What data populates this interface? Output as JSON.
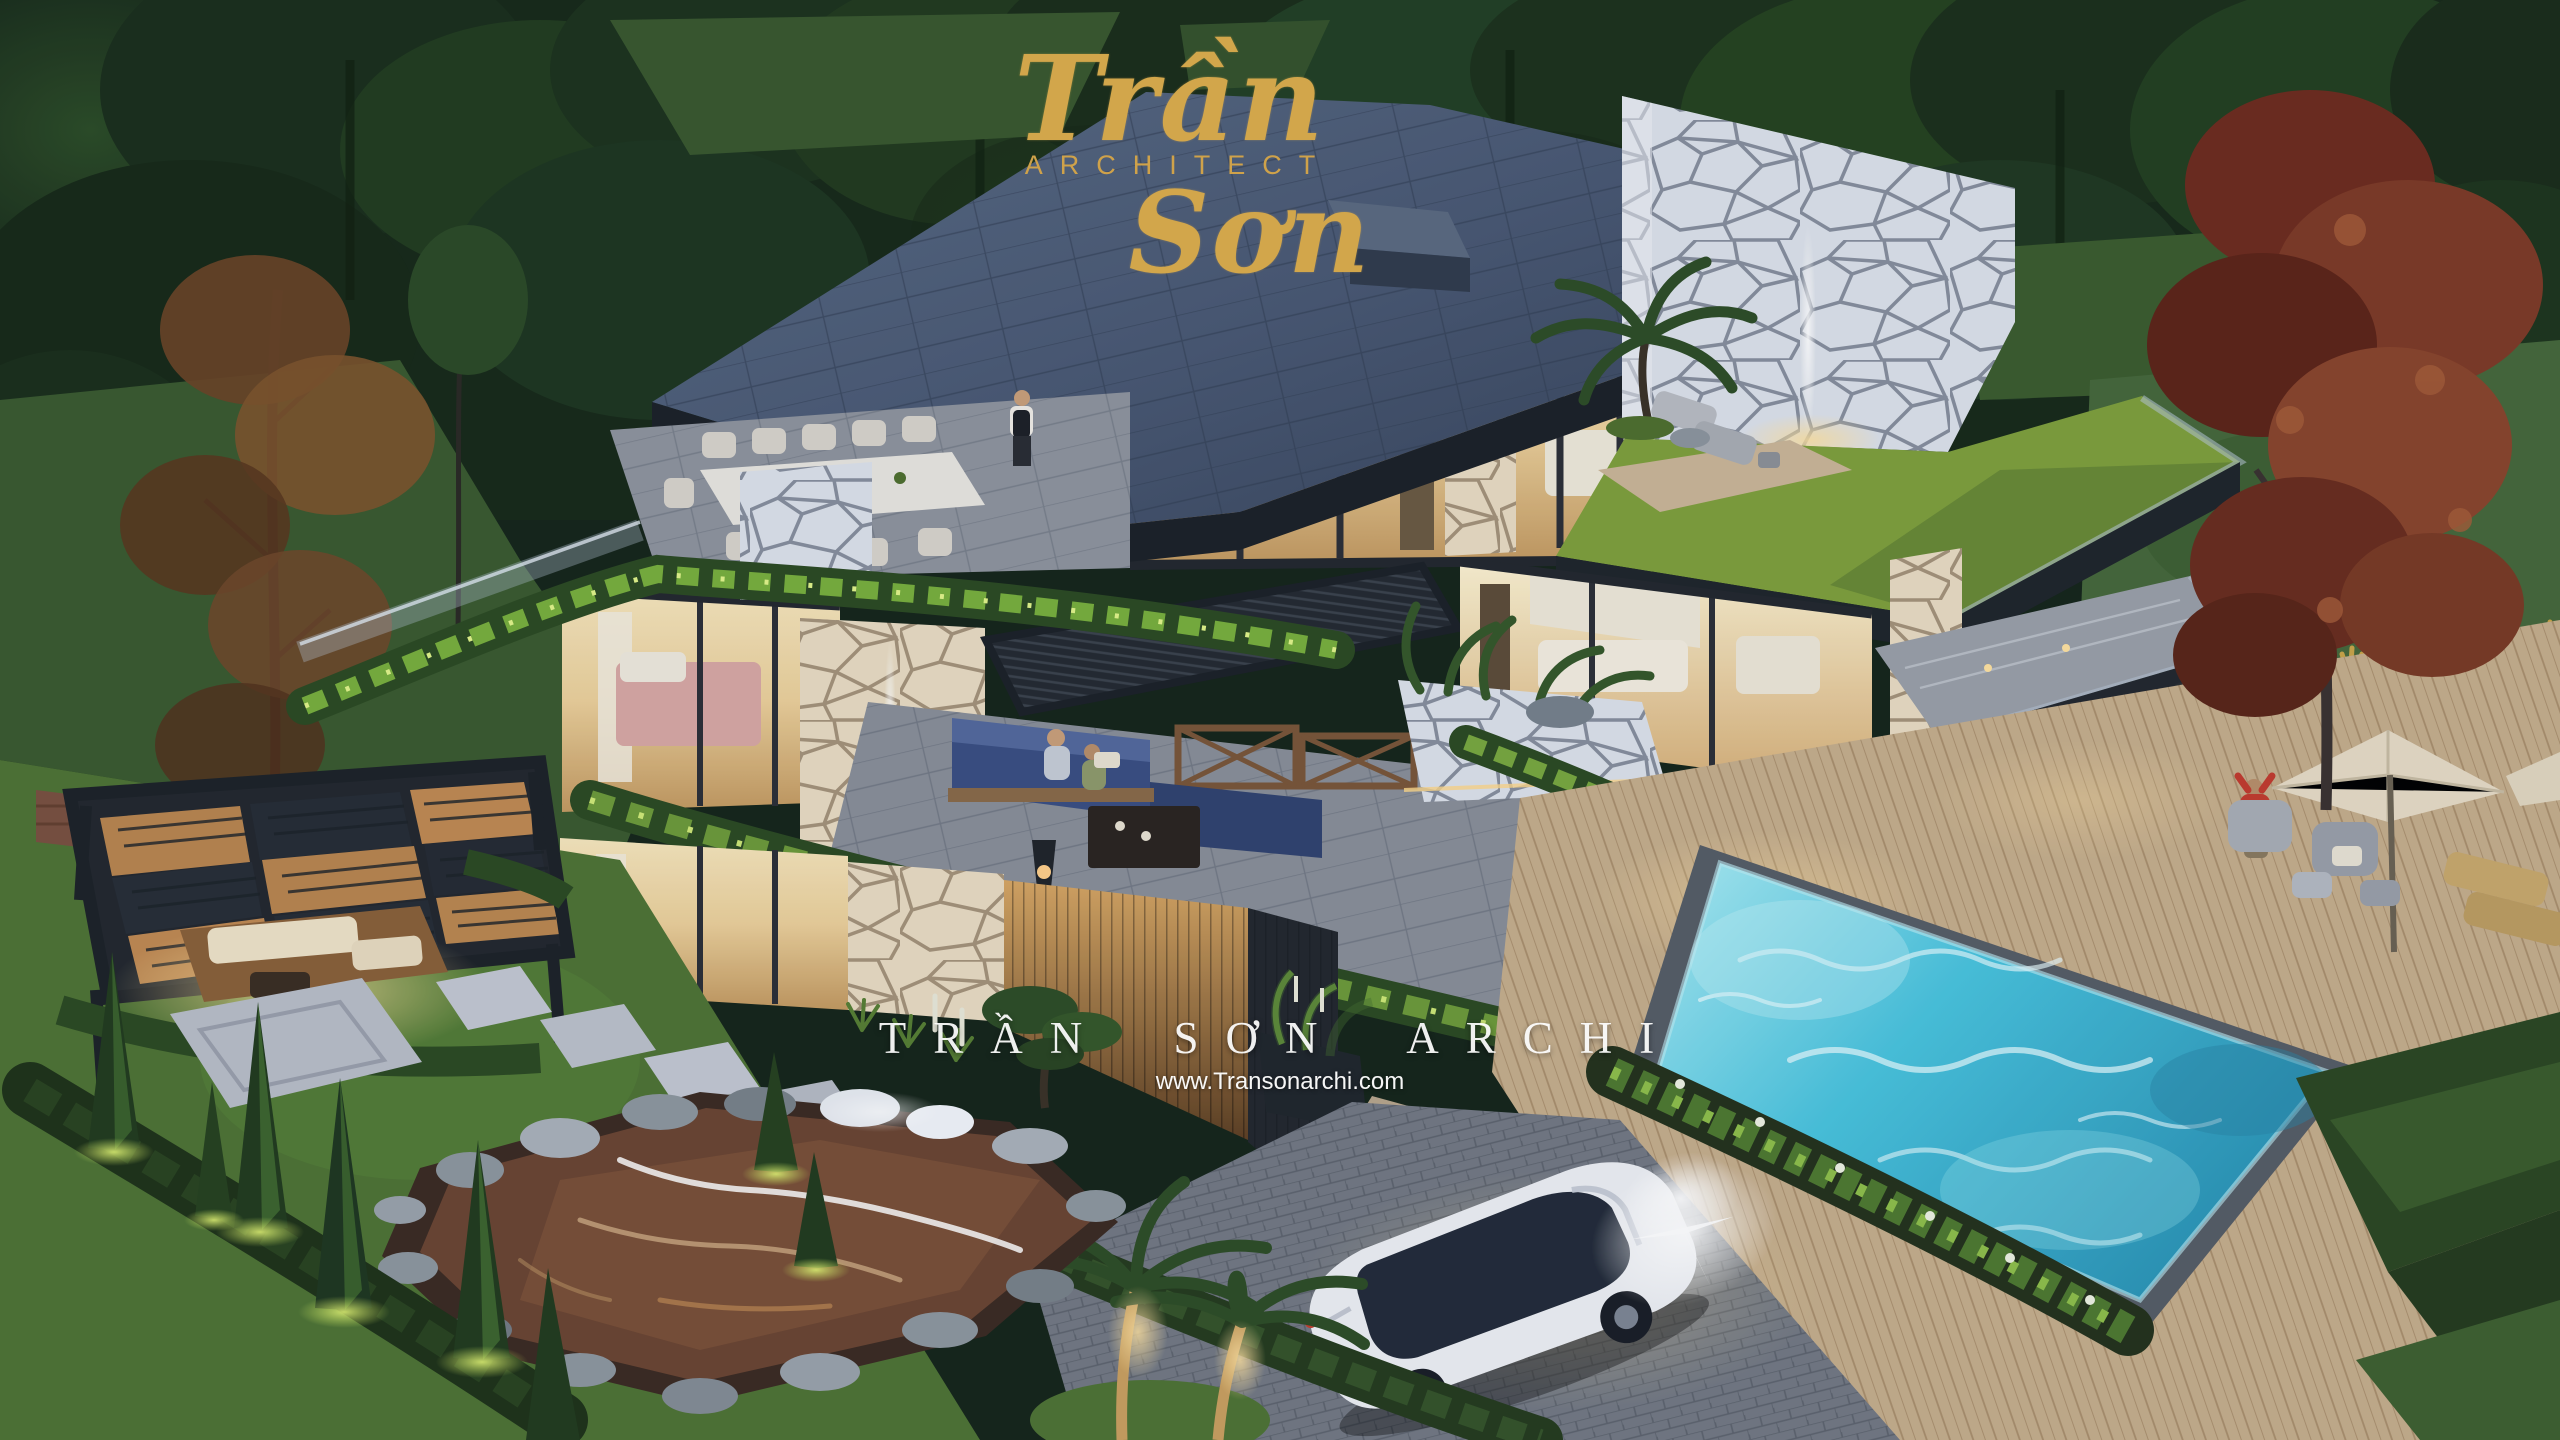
{
  "branding": {
    "name_first": "Trần",
    "subtitle": "ARCHITECT",
    "name_last": "Sơn",
    "gold": "#D2A64B"
  },
  "watermark": {
    "title": "TRẦN SƠN ARCHI",
    "url": "www.Transonarchi.com",
    "color": "#FFFFFF"
  },
  "palette": {
    "forest_dark": "#1B2F1C",
    "lawn_green": "#4E7334",
    "lit_grass": "#A6CF4F",
    "roof_slate": "#4E5D77",
    "fascia_dark": "#1F252B",
    "stone_light": "#DDE2EA",
    "stone_warm": "#E9DCC4",
    "glass_warm": "#F2DFAE",
    "hedge_dark": "#2C4A22",
    "pool_cyan": "#41BEDD",
    "deck_tan": "#C6AE8C",
    "pond_brown": "#6B4532",
    "maple_red": "#7E3A26",
    "car_white": "#EEF0F4"
  }
}
